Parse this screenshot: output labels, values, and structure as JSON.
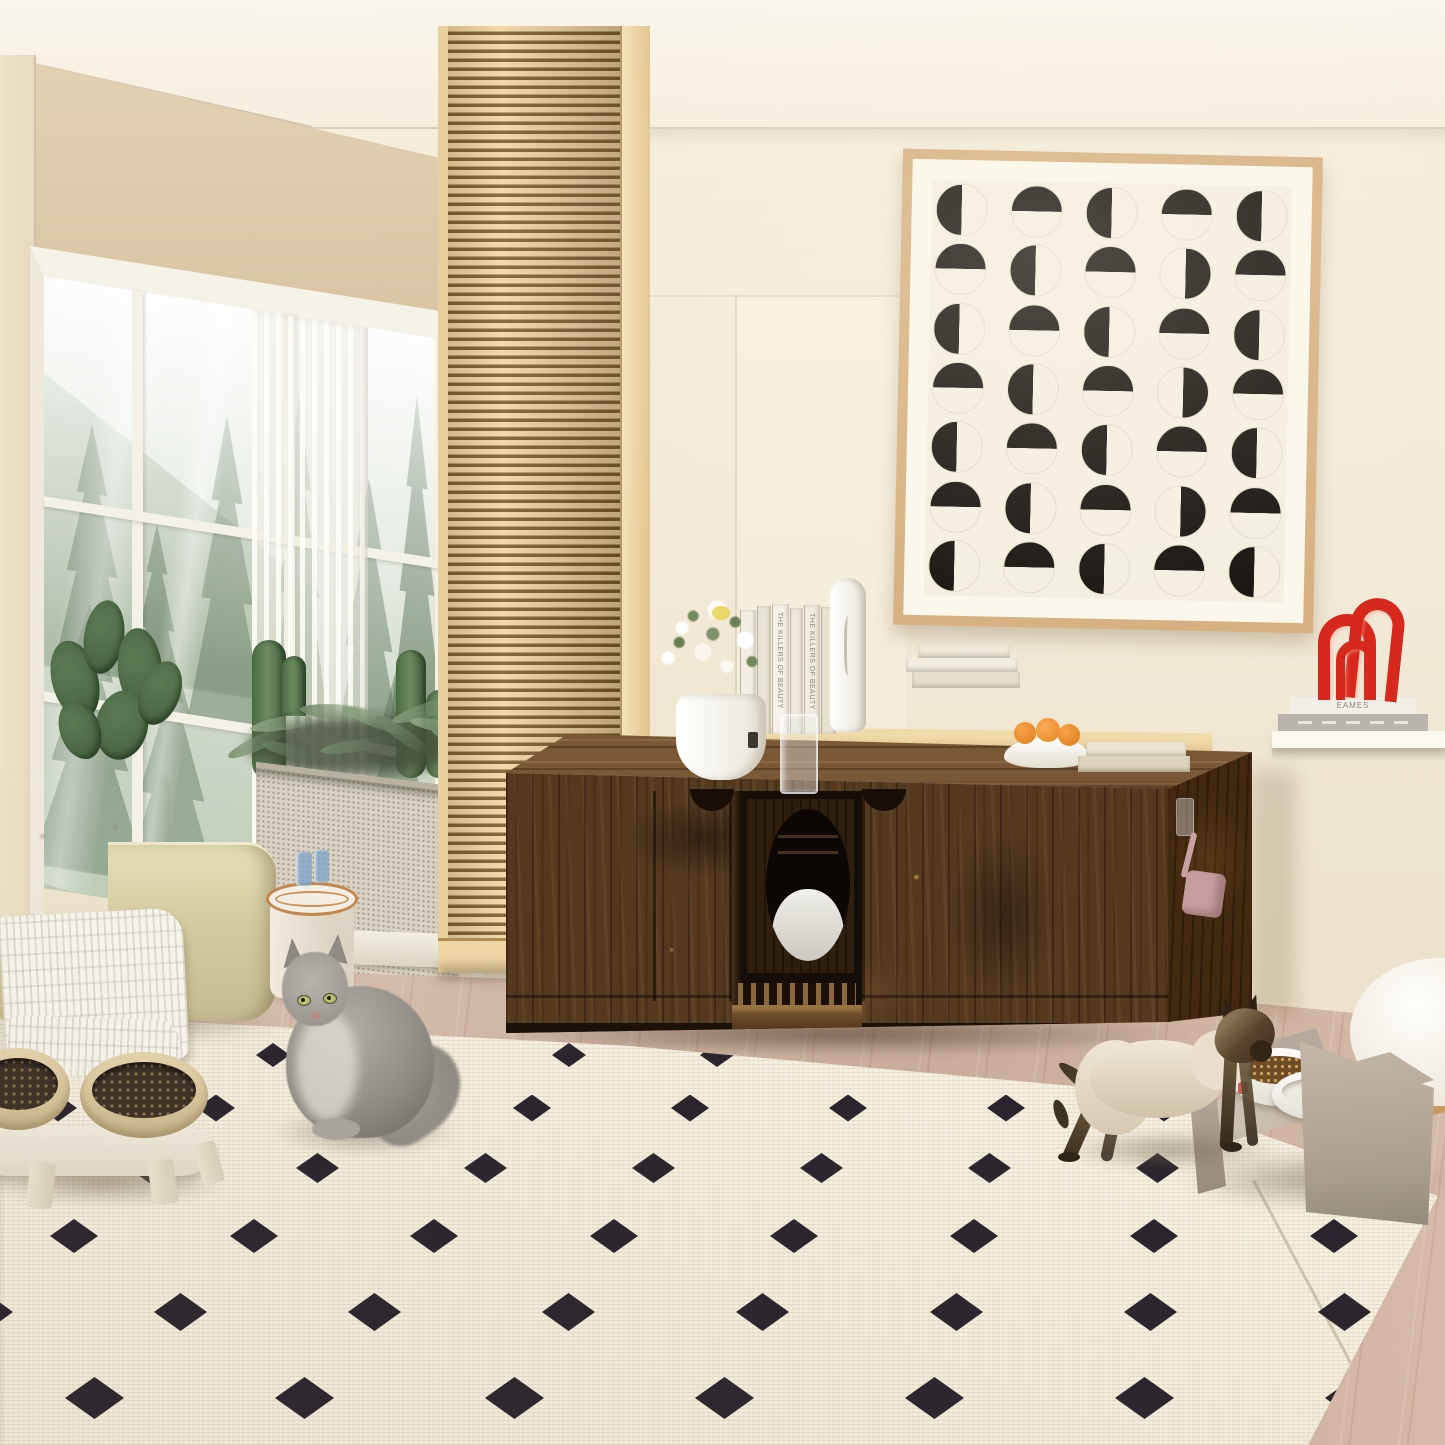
{
  "scene": {
    "type": "interior product photo",
    "room": "living room",
    "subject": "rustic brown wooden cat litter box enclosure cabinet with two cats"
  },
  "palette": {
    "ceiling": "#f9f5ea",
    "wall": "#f2ebda",
    "left_wall": "#e9dcc1",
    "soffit": "#ddc9a9",
    "slat_wood": "#eed7a6",
    "slat_gap": "#6b5026",
    "cabinet_wood": "#54391f",
    "cabinet_top": "#7a5836",
    "floor": "#d2b9a7",
    "rug": "#f1ebd8",
    "rug_diamond": "#1b1520",
    "sofa": "#ddd4aa",
    "art_frame": "#d7b081",
    "art_ink": "#16130f",
    "red_sculpture": "#d6281c",
    "scoop_pink": "#c79ea0",
    "orange_fruit": "#ef9030",
    "forest_green": "#4f6a4d"
  },
  "wall_art": {
    "rows": 7,
    "cols": 5,
    "pattern": [
      [
        "L",
        "T",
        "L",
        "T",
        "L"
      ],
      [
        "T",
        "L",
        "T",
        "R",
        "T"
      ],
      [
        "L",
        "T",
        "L",
        "T",
        "L"
      ],
      [
        "T",
        "L",
        "T",
        "R",
        "T"
      ],
      [
        "L",
        "T",
        "L",
        "T",
        "L"
      ],
      [
        "T",
        "L",
        "T",
        "R",
        "T"
      ],
      [
        "L",
        "T",
        "L",
        "T",
        "L"
      ]
    ]
  },
  "floating_shelf": {
    "spine_text": "THE KILLERS OF BEAUTY",
    "books": [
      {
        "w": 15,
        "c": "#f2eee3",
        "t": 6
      },
      {
        "w": 13,
        "c": "#e9e4d6",
        "t": 2
      },
      {
        "w": 16,
        "c": "#f5f1e8",
        "t": 0
      },
      {
        "w": 12,
        "c": "#eee9dc",
        "t": 4
      },
      {
        "w": 15,
        "c": "#f1ece0",
        "t": 1
      },
      {
        "w": 14,
        "c": "#e7e1d2",
        "t": 3
      }
    ]
  },
  "right_shelf": {
    "top_book_title": "EAMES"
  },
  "rug_pattern": {
    "x_start": -40,
    "count": 11,
    "rows": [
      {
        "y": 1055,
        "spacing": 148,
        "w": 34,
        "h": 24
      },
      {
        "y": 1108,
        "spacing": 158,
        "w": 38,
        "h": 27
      },
      {
        "y": 1168,
        "spacing": 168,
        "w": 43,
        "h": 30
      },
      {
        "y": 1236,
        "spacing": 180,
        "w": 48,
        "h": 34
      },
      {
        "y": 1312,
        "spacing": 194,
        "w": 53,
        "h": 38
      },
      {
        "y": 1398,
        "spacing": 210,
        "w": 59,
        "h": 42
      }
    ]
  },
  "forest_trees": [
    {
      "x": 6,
      "y": 140,
      "w": 84,
      "h": 250,
      "o": 0.5
    },
    {
      "x": 84,
      "y": 230,
      "w": 58,
      "h": 175,
      "o": 0.55
    },
    {
      "x": 140,
      "y": 110,
      "w": 86,
      "h": 310,
      "o": 0.45
    },
    {
      "x": 222,
      "y": 80,
      "w": 66,
      "h": 330,
      "o": 0.55
    },
    {
      "x": 286,
      "y": 150,
      "w": 78,
      "h": 285,
      "o": 0.5
    },
    {
      "x": 344,
      "y": 60,
      "w": 58,
      "h": 330,
      "o": 0.6
    },
    {
      "x": -18,
      "y": 320,
      "w": 128,
      "h": 270,
      "o": 0.55
    },
    {
      "x": 74,
      "y": 350,
      "w": 108,
      "h": 250,
      "o": 0.5
    },
    {
      "x": 190,
      "y": 340,
      "w": 118,
      "h": 260,
      "o": 0.55
    },
    {
      "x": 300,
      "y": 330,
      "w": 108,
      "h": 270,
      "o": 0.5
    }
  ],
  "fern_fronds": [
    {
      "x": 225,
      "y": 735,
      "w": 70,
      "h": 14,
      "r": -25,
      "c": "#7d9472"
    },
    {
      "x": 250,
      "y": 715,
      "w": 80,
      "h": 14,
      "r": -10,
      "c": "#8aa37f"
    },
    {
      "x": 300,
      "y": 705,
      "w": 90,
      "h": 16,
      "r": 5,
      "c": "#748c6b"
    },
    {
      "x": 340,
      "y": 715,
      "w": 80,
      "h": 14,
      "r": 20,
      "c": "#86a07c"
    },
    {
      "x": 370,
      "y": 730,
      "w": 70,
      "h": 13,
      "r": 35,
      "c": "#6f876a"
    },
    {
      "x": 390,
      "y": 700,
      "w": 90,
      "h": 15,
      "r": -18,
      "c": "#7e9775"
    },
    {
      "x": 410,
      "y": 720,
      "w": 60,
      "h": 12,
      "r": 10,
      "c": "#8fa886"
    },
    {
      "x": 260,
      "y": 745,
      "w": 60,
      "h": 12,
      "r": 15,
      "c": "#667e5f"
    },
    {
      "x": 320,
      "y": 740,
      "w": 70,
      "h": 12,
      "r": -8,
      "c": "#70886a"
    },
    {
      "x": 430,
      "y": 735,
      "w": 50,
      "h": 11,
      "r": 25,
      "c": "#7a9171"
    }
  ]
}
